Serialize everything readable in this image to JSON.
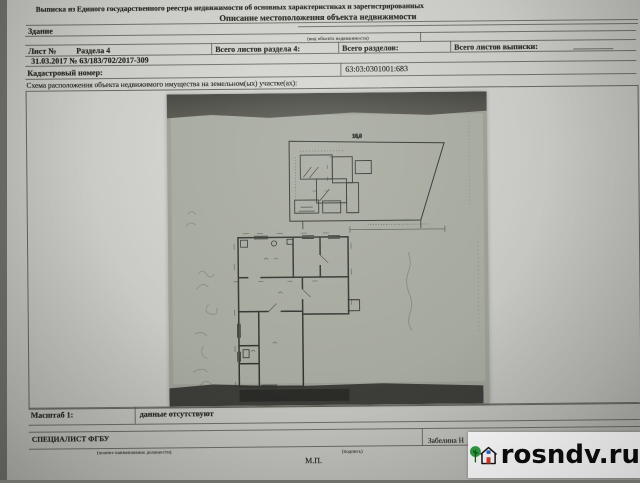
{
  "document": {
    "header_line1": "Выписка из Единого государственного реестра недвижимости об основных характеристиках и зарегистрированных",
    "header_line2": "Описание местоположения объекта недвижимости",
    "object_type": "Здание",
    "object_type_caption": "(вид объекта недвижимости)",
    "sheet_label": "Лист №",
    "section_label": "Раздела 4",
    "sheets_total_label": "Всего листов раздела 4:",
    "sections_total_label": "Всего разделов:",
    "extract_sheets_total_label": "Всего листов выписки:",
    "date_number_line": "31.03.2017    №    63/183/702/2017-309",
    "cadastral_label": "Кадастровый номер:",
    "cadastral_number": "63:03:0301001:683",
    "schema_caption": "Схема расположения объекта недвижимого имущества на земельном(ых) участке(ах):",
    "scale_label": "Масштаб 1:",
    "scale_value": "данные отсутствуют",
    "specialist_label": "СПЕЦИАЛИСТ ФГБУ",
    "position_caption": "(полное наименование должности)",
    "signature_caption": "(подпись)",
    "signer_name": "Забелина Н",
    "stamp_label": "М.П."
  },
  "drawing": {
    "top_dimension_label": "16,0"
  },
  "watermark": {
    "site": "rosndv.ru",
    "colors": {
      "tree": "#2f9e41",
      "window": "#2b62c9",
      "door": "#d63a2c",
      "house_outline": "#141414"
    }
  }
}
